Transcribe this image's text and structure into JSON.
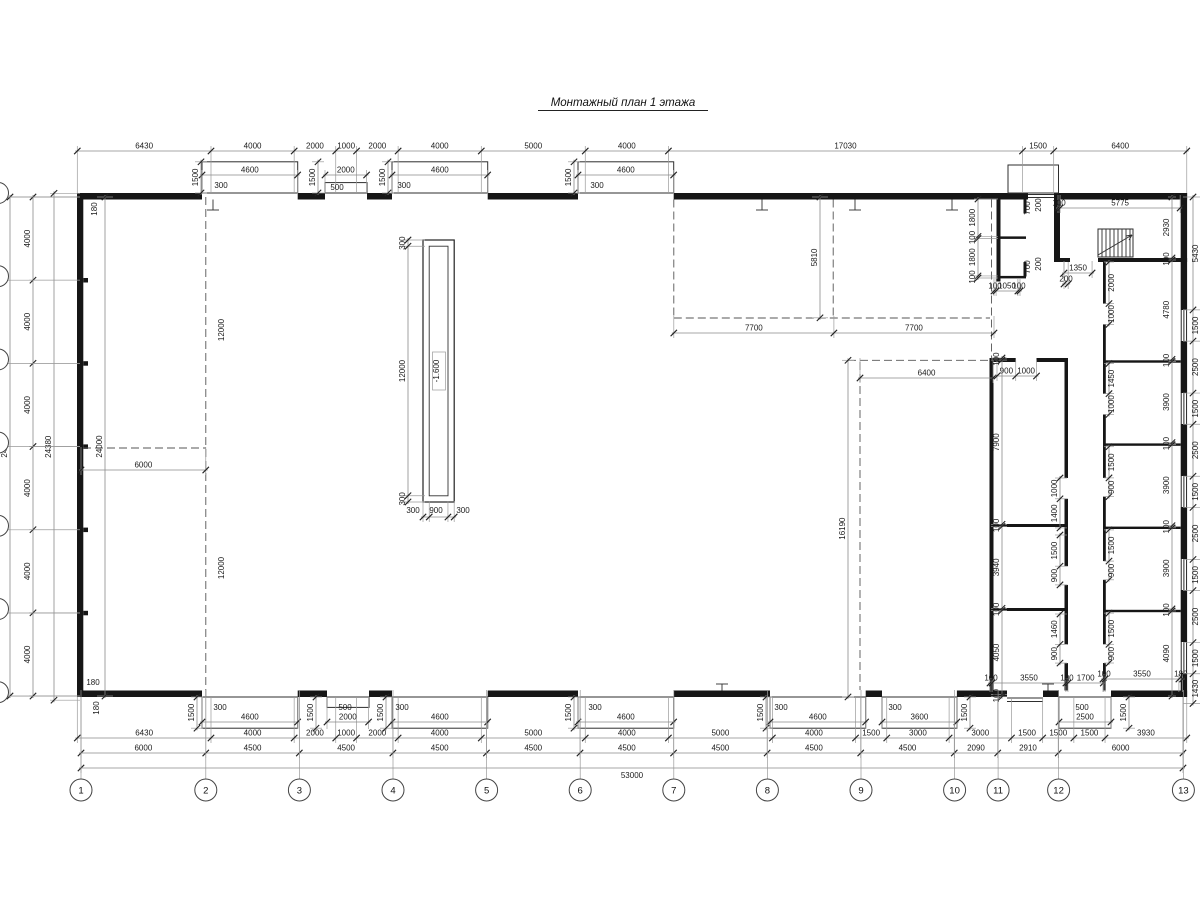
{
  "title": {
    "text": "Монтажный план 1 этажа"
  },
  "plan": {
    "scale_px_per_mm": 0.020792,
    "chains": [
      {
        "id": "top-main",
        "o": "h",
        "p": 151,
        "s": 77.3,
        "e1": 42,
        "e2": -5,
        "v": [
          6430,
          4000,
          2000,
          1000,
          2000,
          4000,
          5000,
          4000,
          17030,
          1500,
          6400
        ]
      },
      {
        "id": "top-gate1",
        "o": "h",
        "p": 175,
        "s": 202,
        "e1": 19,
        "e2": -5,
        "v": [
          4600
        ]
      },
      {
        "id": "top-gate2",
        "o": "h",
        "p": 175,
        "s": 325,
        "e1": 19,
        "e2": -5,
        "v": [
          2000
        ]
      },
      {
        "id": "top-gate3",
        "o": "h",
        "p": 175,
        "s": 392,
        "e1": 19,
        "e2": -5,
        "v": [
          4600
        ]
      },
      {
        "id": "top-gate4",
        "o": "h",
        "p": 175,
        "s": 578,
        "e1": 19,
        "e2": -5,
        "v": [
          4600
        ]
      },
      {
        "id": "bot-row1",
        "o": "h",
        "p": 738,
        "s": 77.3,
        "e1": -41,
        "e2": 5,
        "v": [
          6430,
          4000,
          2000,
          1000,
          2000,
          4000,
          5000,
          4000,
          5000,
          4000,
          1500,
          3000,
          3000,
          1500,
          1500,
          1500,
          3930
        ]
      },
      {
        "id": "bot-row2",
        "o": "h",
        "p": 753,
        "s": 81,
        "e1": -56,
        "e2": 5,
        "v": [
          6000,
          4500,
          4500,
          4500,
          4500,
          4500,
          4500,
          4500,
          4500,
          2090,
          2910,
          6000
        ]
      },
      {
        "id": "bot-row3",
        "o": "h",
        "p": 768,
        "s": 81,
        "e1": -71,
        "e2": 5,
        "lb": true,
        "v": [
          53000
        ]
      },
      {
        "id": "bot-gate1",
        "o": "h",
        "p": 722,
        "s": 202,
        "e1": -25,
        "e2": 7,
        "v": [
          4600
        ]
      },
      {
        "id": "bot-gate2",
        "o": "h",
        "p": 722,
        "s": 327,
        "e1": -25,
        "e2": 7,
        "v": [
          2000
        ]
      },
      {
        "id": "bot-gate3",
        "o": "h",
        "p": 722,
        "s": 392,
        "e1": -25,
        "e2": 7,
        "v": [
          4600
        ]
      },
      {
        "id": "bot-gate4",
        "o": "h",
        "p": 722,
        "s": 578,
        "e1": -25,
        "e2": 7,
        "v": [
          4600
        ]
      },
      {
        "id": "bot-gate5",
        "o": "h",
        "p": 722,
        "s": 770,
        "e1": -25,
        "e2": 7,
        "v": [
          4600
        ]
      },
      {
        "id": "bot-gate6",
        "o": "h",
        "p": 722,
        "s": 882,
        "e1": -25,
        "e2": 7,
        "v": [
          3600
        ]
      },
      {
        "id": "bot-gate7",
        "o": "h",
        "p": 722,
        "s": 1059,
        "e1": -25,
        "e2": 7,
        "v": [
          2500
        ]
      },
      {
        "id": "mid-7700",
        "o": "h",
        "p": 333,
        "s": 673.8,
        "e1": -17,
        "e2": 5,
        "v": [
          7700,
          7700
        ]
      },
      {
        "id": "mid-6400",
        "o": "h",
        "p": 378,
        "s": 860,
        "e1": -20,
        "e2": 5,
        "v": [
          6400
        ]
      },
      {
        "id": "room-door-top",
        "o": "h",
        "p": 376,
        "s": 997,
        "e1": -16,
        "e2": 5,
        "v": [
          900,
          1000
        ]
      },
      {
        "id": "bot-inner1",
        "o": "h",
        "p": 683,
        "s": 990,
        "e1": 9,
        "e2": -5,
        "v": [
          100,
          3550,
          100,
          1700
        ]
      },
      {
        "id": "bot-inner2",
        "o": "h",
        "p": 679,
        "s": 1103,
        "e1": 13,
        "e2": -5,
        "v": [
          100,
          3550,
          180
        ]
      },
      {
        "id": "stair-width",
        "o": "h",
        "p": 208,
        "s": 1058,
        "e1": -13,
        "e2": 5,
        "v": [
          100,
          5775
        ]
      },
      {
        "id": "stair-door",
        "o": "h",
        "p": 273,
        "s": 1064,
        "e1": -12,
        "e2": 5,
        "v": [
          1350
        ]
      },
      {
        "id": "stair-door2",
        "o": "h",
        "p": 284,
        "s": 1064,
        "e1": -22,
        "e2": 5,
        "v": [
          200
        ]
      },
      {
        "id": "e-door",
        "o": "h",
        "p": 291,
        "s": 994,
        "e1": -12,
        "e2": 5,
        "v": [
          100,
          1050,
          100
        ]
      },
      {
        "id": "hall-6000",
        "o": "h",
        "p": 470,
        "s": 81,
        "e1": -23,
        "e2": 5,
        "v": [
          6000
        ]
      },
      {
        "id": "pit-width",
        "o": "h",
        "p": 517,
        "s": 423,
        "e1": -16,
        "e2": 5,
        "nl": true,
        "v": [
          300,
          900,
          300
        ]
      },
      {
        "id": "left-24000",
        "o": "v",
        "p": 10,
        "s": 197,
        "e1": -4,
        "e2": 70,
        "v": [
          24000
        ]
      },
      {
        "id": "left-4000",
        "o": "v",
        "p": 33,
        "s": 197,
        "e1": -4,
        "e2": 47,
        "v": [
          4000,
          4000,
          4000,
          4000,
          4000,
          4000
        ]
      },
      {
        "id": "left-24380",
        "o": "v",
        "p": 54,
        "s": 193.3,
        "e1": -4,
        "e2": 26,
        "v": [
          24380
        ]
      },
      {
        "id": "left-inner-24000",
        "o": "v",
        "p": 105,
        "s": 197,
        "e1": -8,
        "e2": 8,
        "v": [
          24000
        ]
      },
      {
        "id": "right-margin",
        "o": "v",
        "p": 1193,
        "s": 197,
        "e1": -10,
        "e2": 7,
        "ls": true,
        "v": [
          5430,
          1500,
          2500,
          1500,
          2500,
          1500,
          2500,
          1500,
          2500,
          1500,
          1430
        ]
      },
      {
        "id": "rooms-heights",
        "o": "v",
        "p": 1172,
        "s": 197,
        "e1": -4,
        "e2": 4,
        "v": [
          2930,
          100,
          4780,
          100,
          3900,
          100,
          3900,
          100,
          3900,
          100,
          4090
        ]
      },
      {
        "id": "rooms2-heights",
        "o": "v",
        "p": 1002,
        "s": 358,
        "e1": -11,
        "e2": 5,
        "v": [
          100,
          7900,
          100,
          3940,
          100,
          4050,
          100
        ]
      },
      {
        "id": "r2-door1",
        "o": "v",
        "p": 1060,
        "s": 478,
        "e1": -5,
        "e2": 7,
        "v": [
          1000,
          1400
        ]
      },
      {
        "id": "r2-door2",
        "o": "v",
        "p": 1060,
        "s": 535,
        "e1": -5,
        "e2": 7,
        "v": [
          1500,
          900
        ]
      },
      {
        "id": "r2-door3",
        "o": "v",
        "p": 1060,
        "s": 614,
        "e1": -5,
        "e2": 7,
        "v": [
          1460,
          900
        ]
      },
      {
        "id": "r1-door1",
        "o": "v",
        "p": 1109,
        "s": 262,
        "e1": -5,
        "e2": 5,
        "ls": true,
        "v": [
          2000,
          1000
        ]
      },
      {
        "id": "r1-door2",
        "o": "v",
        "p": 1109,
        "s": 363.5,
        "e1": -5,
        "e2": 5,
        "ls": true,
        "v": [
          1450,
          1000
        ]
      },
      {
        "id": "r1-door3",
        "o": "v",
        "p": 1109,
        "s": 446.7,
        "e1": -5,
        "e2": 5,
        "ls": true,
        "v": [
          1500,
          900
        ]
      },
      {
        "id": "r1-door4",
        "o": "v",
        "p": 1109,
        "s": 529.9,
        "e1": -5,
        "e2": 5,
        "ls": true,
        "v": [
          1500,
          900
        ]
      },
      {
        "id": "r1-door5",
        "o": "v",
        "p": 1109,
        "s": 613.1,
        "e1": -5,
        "e2": 5,
        "ls": true,
        "v": [
          1500,
          900
        ]
      },
      {
        "id": "mid-5810",
        "o": "v",
        "p": 820,
        "s": 197,
        "e1": -8,
        "e2": 8,
        "v": [
          5810
        ]
      },
      {
        "id": "mid-16190",
        "o": "v",
        "p": 848,
        "s": 360.3,
        "e1": -6,
        "e2": 6,
        "v": [
          16190
        ]
      },
      {
        "id": "pit-height",
        "o": "v",
        "p": 408,
        "s": 240,
        "e1": -5,
        "e2": 17,
        "v": [
          300,
          12000,
          300
        ]
      },
      {
        "id": "e-left",
        "o": "v",
        "p": 978,
        "s": 199,
        "e1": -4,
        "e2": 20,
        "v": [
          1800,
          100,
          1800,
          100
        ]
      },
      {
        "id": "tg-depth1",
        "o": "v",
        "p": 201,
        "s": 161.8,
        "e1": -6,
        "e2": 6,
        "v": [
          1500
        ]
      },
      {
        "id": "tg-depth2",
        "o": "v",
        "p": 318,
        "s": 161.8,
        "e1": -6,
        "e2": 6,
        "v": [
          1500
        ]
      },
      {
        "id": "tg-depth3",
        "o": "v",
        "p": 388,
        "s": 161.8,
        "e1": -6,
        "e2": 6,
        "v": [
          1500
        ]
      },
      {
        "id": "tg-depth4",
        "o": "v",
        "p": 574,
        "s": 161.8,
        "e1": -6,
        "e2": 6,
        "v": [
          1500
        ]
      },
      {
        "id": "bg-depth1",
        "o": "v",
        "p": 197,
        "s": 697,
        "e1": -6,
        "e2": 6,
        "v": [
          1500
        ]
      },
      {
        "id": "bg-depth2",
        "o": "v",
        "p": 316,
        "s": 697,
        "e1": -6,
        "e2": 6,
        "v": [
          1500
        ]
      },
      {
        "id": "bg-depth3",
        "o": "v",
        "p": 386,
        "s": 697,
        "e1": -6,
        "e2": 6,
        "v": [
          1500
        ]
      },
      {
        "id": "bg-depth4",
        "o": "v",
        "p": 574,
        "s": 697,
        "e1": -6,
        "e2": 6,
        "v": [
          1500
        ]
      },
      {
        "id": "bg-depth5",
        "o": "v",
        "p": 766,
        "s": 697,
        "e1": -6,
        "e2": 6,
        "v": [
          1500
        ]
      },
      {
        "id": "bg-depth6",
        "o": "v",
        "p": 970,
        "s": 697,
        "e1": -6,
        "e2": 6,
        "v": [
          1500
        ]
      },
      {
        "id": "bg-depth7",
        "o": "v",
        "p": 1129,
        "s": 697,
        "e1": -6,
        "e2": 6,
        "v": [
          1500
        ]
      }
    ],
    "free_labels": [
      {
        "t": "180",
        "x": 97,
        "y": 209,
        "r": -90
      },
      {
        "t": "180",
        "x": 93,
        "y": 685,
        "r": 0
      },
      {
        "t": "180",
        "x": 99,
        "y": 708,
        "r": -90
      },
      {
        "t": "12000",
        "x": 224,
        "y": 330,
        "r": -90
      },
      {
        "t": "12000",
        "x": 224,
        "y": 568,
        "r": -90
      },
      {
        "t": "-1.600",
        "x": 439,
        "y": 371,
        "r": -90,
        "box": true
      },
      {
        "t": "300",
        "x": 413,
        "y": 513,
        "r": 0
      },
      {
        "t": "900",
        "x": 436,
        "y": 513,
        "r": 0
      },
      {
        "t": "300",
        "x": 463,
        "y": 513,
        "r": 0
      },
      {
        "t": "300",
        "x": 221,
        "y": 188,
        "r": 0
      },
      {
        "t": "300",
        "x": 404,
        "y": 188,
        "r": 0
      },
      {
        "t": "300",
        "x": 597,
        "y": 188,
        "r": 0
      },
      {
        "t": "500",
        "x": 337,
        "y": 190,
        "r": 0
      },
      {
        "t": "300",
        "x": 220,
        "y": 710,
        "r": 0
      },
      {
        "t": "300",
        "x": 402,
        "y": 710,
        "r": 0
      },
      {
        "t": "300",
        "x": 595,
        "y": 710,
        "r": 0
      },
      {
        "t": "300",
        "x": 781,
        "y": 710,
        "r": 0
      },
      {
        "t": "300",
        "x": 895,
        "y": 710,
        "r": 0
      },
      {
        "t": "500",
        "x": 345,
        "y": 710,
        "r": 0
      },
      {
        "t": "500",
        "x": 1082,
        "y": 710,
        "r": 0
      },
      {
        "t": "700",
        "x": 1030,
        "y": 208,
        "r": -90
      },
      {
        "t": "200",
        "x": 1041,
        "y": 205,
        "r": -90
      },
      {
        "t": "700",
        "x": 1030,
        "y": 267,
        "r": -90
      },
      {
        "t": "200",
        "x": 1041,
        "y": 264,
        "r": -90
      }
    ],
    "axes": {
      "bottom": [
        {
          "n": "1",
          "x": 81
        },
        {
          "n": "2",
          "x": 205.8
        },
        {
          "n": "3",
          "x": 299.4
        },
        {
          "n": "4",
          "x": 393
        },
        {
          "n": "5",
          "x": 486.6
        },
        {
          "n": "6",
          "x": 580.2
        },
        {
          "n": "7",
          "x": 673.8
        },
        {
          "n": "8",
          "x": 767.4
        },
        {
          "n": "9",
          "x": 861
        },
        {
          "n": "10",
          "x": 954.6
        },
        {
          "n": "11",
          "x": 998.1
        },
        {
          "n": "12",
          "x": 1058.6
        },
        {
          "n": "13",
          "x": 1183.4
        }
      ],
      "bottom_y": 790,
      "left_ys": [
        197,
        280.2,
        363.4,
        446.6,
        529.8,
        613,
        696.2
      ]
    }
  }
}
